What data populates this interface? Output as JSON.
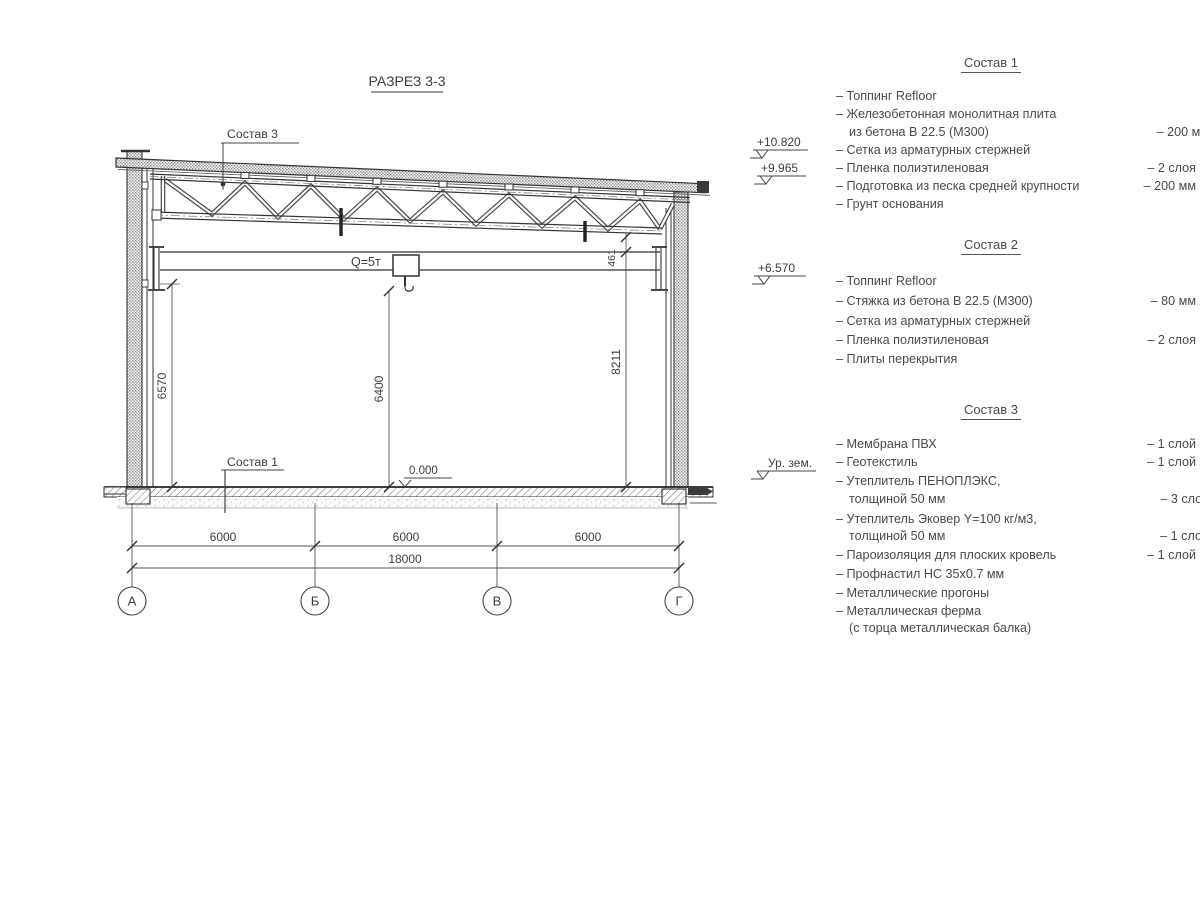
{
  "title": "РАЗРЕЗ 3-3",
  "section": {
    "crane_label": "Q=5т",
    "zero_mark": "0.000",
    "roof_ref_label": "Состав 3",
    "floor_ref_label": "Состав 1",
    "dims": {
      "left_height": "6570",
      "hook_height": "6400",
      "right_height": "8211",
      "truss_clearance": "461",
      "bay1": "6000",
      "bay2": "6000",
      "bay3": "6000",
      "total": "18000"
    },
    "axes": [
      "А",
      "Б",
      "В",
      "Г"
    ],
    "elevations": [
      "+10.820",
      "+9.965",
      "+6.570",
      "Ур. зем."
    ]
  },
  "lists": [
    {
      "header": "Состав 1",
      "items": [
        {
          "text": "– Топпинг Refloor",
          "value": ""
        },
        {
          "text": "– Железобетонная монолитная плита",
          "value": ""
        },
        {
          "text": "из бетона В 22.5 (М300)",
          "value": "– 200 мм"
        },
        {
          "text": "– Сетка из арматурных стержней",
          "value": ""
        },
        {
          "text": "– Пленка полиэтиленовая",
          "value": "– 2 слоя"
        },
        {
          "text": "– Подготовка из песка средней крупности",
          "value": "– 200 мм"
        },
        {
          "text": "– Грунт основания",
          "value": ""
        }
      ]
    },
    {
      "header": "Состав 2",
      "items": [
        {
          "text": "– Топпинг Refloor",
          "value": ""
        },
        {
          "text": "– Стяжка из бетона В 22.5 (М300)",
          "value": "– 80 мм"
        },
        {
          "text": "– Сетка из арматурных стержней",
          "value": ""
        },
        {
          "text": "– Пленка полиэтиленовая",
          "value": "– 2 слоя"
        },
        {
          "text": "– Плиты перекрытия",
          "value": ""
        }
      ]
    },
    {
      "header": "Состав 3",
      "items": [
        {
          "text": "– Мембрана ПВХ",
          "value": "– 1 слой"
        },
        {
          "text": "– Геотекстиль",
          "value": "– 1 слой"
        },
        {
          "text": "– Утеплитель ПЕНОПЛЭКС,",
          "value": ""
        },
        {
          "text": "толщиной 50 мм",
          "value": "– 3 слоя"
        },
        {
          "text": "– Утеплитель Эковер Y=100 кг/м3,",
          "value": ""
        },
        {
          "text": "толщиной 50 мм",
          "value": "– 1 слой"
        },
        {
          "text": "– Пароизоляция для плоских кровель",
          "value": "– 1 слой"
        },
        {
          "text": "– Профнастил НС 35х0.7 мм",
          "value": ""
        },
        {
          "text": "– Металлические прогоны",
          "value": ""
        },
        {
          "text": "– Металлическая ферма",
          "value": ""
        },
        {
          "text": "(с торца металлическая балка)",
          "value": ""
        }
      ]
    }
  ]
}
